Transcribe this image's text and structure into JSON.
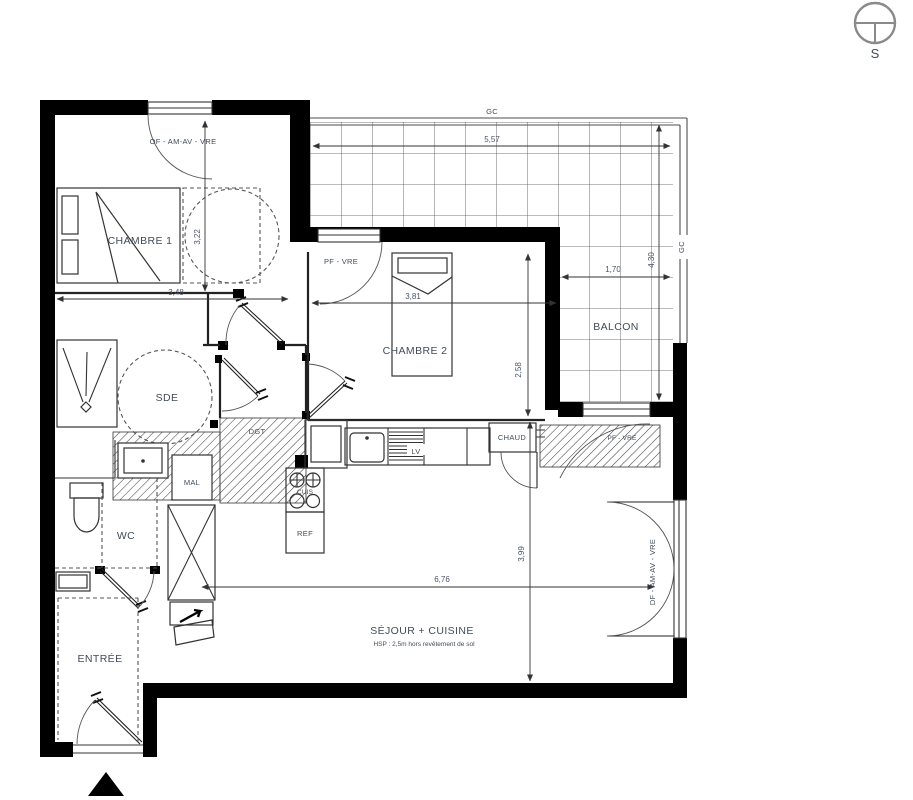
{
  "compass": {
    "south": "S"
  },
  "rooms": {
    "chambre1": {
      "name": "CHAMBRE 1"
    },
    "chambre2": {
      "name": "CHAMBRE 2"
    },
    "sde": {
      "name": "SDE"
    },
    "wc": {
      "name": "WC"
    },
    "entree": {
      "name": "ENTRÉE"
    },
    "sejour": {
      "name": "SÉJOUR + CUISINE",
      "note": "HSP : 2,5m hors revêtement de sol"
    },
    "balcon": {
      "name": "BALCON"
    },
    "dgt": {
      "name": "DGT"
    }
  },
  "fixtures": {
    "mal": "MAL",
    "ref": "REF",
    "cuis": "CUIS",
    "lv": "LV",
    "chaud": "CHAUD"
  },
  "openings": {
    "chambre1_window": "OF - AM-AV - VRE",
    "chambre2_window": "PF - VRE",
    "balcony_door": "PF - VRE",
    "french_door": "DF - AM-AV - VRE",
    "guardrail_top": "GC",
    "guardrail_right": "GC"
  },
  "dimensions": {
    "chambre1_width": "3,48",
    "chambre1_depth": "3,22",
    "chambre2_width": "3,81",
    "chambre2_depth": "2,58",
    "balcon_width": "5,57",
    "balcon_inner": "1,70",
    "balcon_depth": "4,30",
    "sejour_width": "6,76",
    "sejour_depth": "3,99"
  },
  "colors": {
    "wall": "#000000",
    "label": "#414c59",
    "dim": "#4a5568"
  }
}
